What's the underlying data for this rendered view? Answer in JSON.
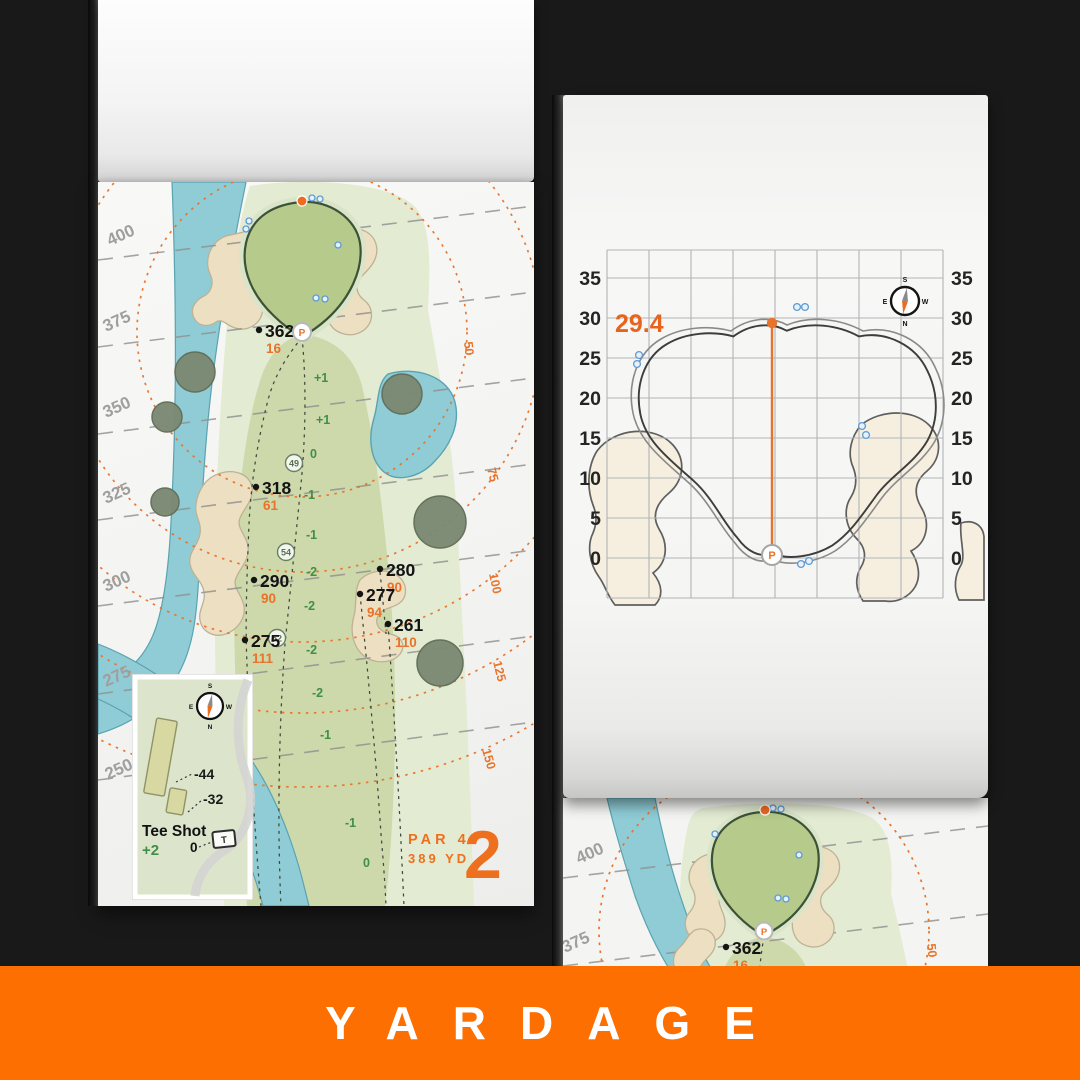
{
  "banner": {
    "label": "YARDAGE"
  },
  "colors": {
    "banner_orange": "#fc6f00",
    "accent_orange": "#e8732a",
    "green_text": "#3f8f46",
    "putting_green": "#b6ca8c",
    "fairway": "#cdd9ab",
    "rough": "#e3ebd3",
    "water": "#8fccd6",
    "sand": "#ecdfc2",
    "grid_gray": "#b0b4b8"
  },
  "left_page": {
    "hole_number": "2",
    "par_label": "PAR 4",
    "yardage_label": "389 YD",
    "yard_lines": [
      "400",
      "375",
      "350",
      "325",
      "300",
      "275",
      "250"
    ],
    "arc_labels": [
      "50",
      "75",
      "100",
      "125",
      "150"
    ],
    "points": [
      {
        "carry": "362",
        "front": "16"
      },
      {
        "carry": "318",
        "front": "61"
      },
      {
        "carry": "290",
        "front": "90"
      },
      {
        "carry": "275",
        "front": "111"
      },
      {
        "carry": "280",
        "front": "90"
      },
      {
        "carry": "277",
        "front": "94"
      },
      {
        "carry": "261",
        "front": "110"
      }
    ],
    "lay_values": [
      "+1",
      "+1",
      "0",
      "-1",
      "-1",
      "-2",
      "-2",
      "-2",
      "-2",
      "-1",
      "-1",
      "0"
    ],
    "circled_values": [
      "49",
      "54",
      "52"
    ],
    "pin_label": "P",
    "compass": {
      "n": "N",
      "s": "S",
      "e": "E",
      "w": "W"
    },
    "inset": {
      "title": "Tee Shot",
      "elevation": "+2",
      "origin": "0",
      "dist_back": "-44",
      "dist_front": "-32",
      "tee_mark": "T"
    }
  },
  "right_page": {
    "depth_value": "29.4",
    "axis_ticks": [
      "35",
      "30",
      "25",
      "20",
      "15",
      "10",
      "5",
      "0"
    ],
    "pin_label": "P",
    "compass": {
      "n": "N",
      "s": "S",
      "e": "E",
      "w": "W"
    }
  },
  "next_page": {
    "yard_lines": [
      "400",
      "375"
    ],
    "point": {
      "carry": "362",
      "front": "16"
    },
    "arc_label": "50",
    "pin_label": "P"
  }
}
